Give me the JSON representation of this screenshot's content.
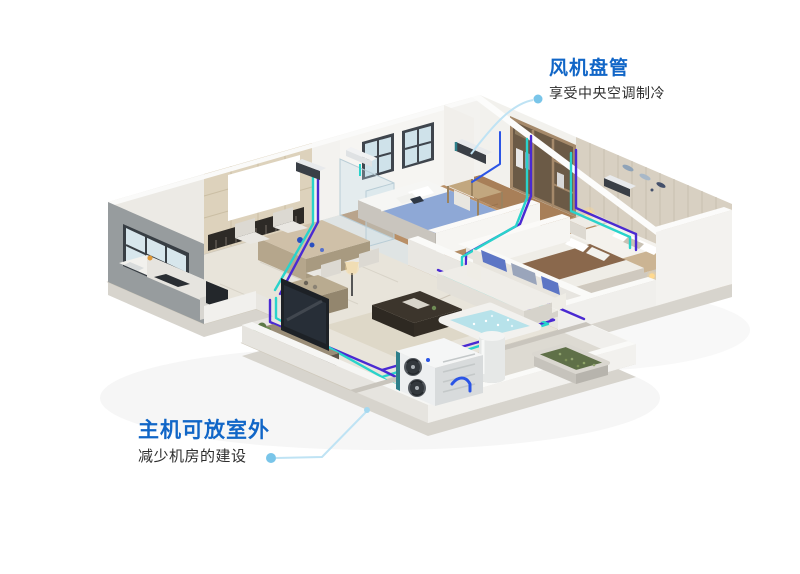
{
  "background": "#ffffff",
  "callouts": {
    "fan_coil": {
      "title": "风机盘管",
      "subtitle": "享受中央空调制冷"
    },
    "main_unit": {
      "title": "主机可放室外",
      "subtitle": "减少机房的建设"
    }
  },
  "colors": {
    "callout_title": "#1166c7",
    "callout_subtitle": "#2e2e2e",
    "leader_line": "#bfe3f4",
    "leader_dot": "#79c5e9",
    "pipe_purple": "#4a2ad2",
    "pipe_cyan": "#29d3cb",
    "pipe_blue": "#2b55e6"
  }
}
